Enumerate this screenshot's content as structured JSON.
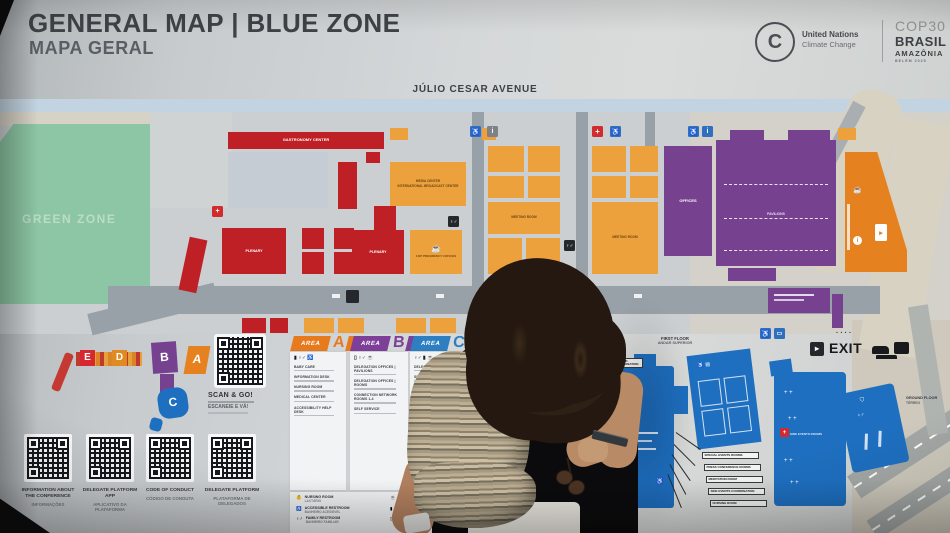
{
  "header": {
    "title": "GENERAL MAP | BLUE ZONE",
    "subtitle": "MAPA GERAL"
  },
  "logos": {
    "un_line1": "United Nations",
    "un_line2": "Climate Change",
    "cop": "COP30",
    "brasil": "BRASIL",
    "amazonia": "AMAZÔNIA",
    "belem": "BELÉM 2025"
  },
  "map": {
    "avenue": "JÚLIO CESAR AVENUE",
    "green_zone": "GREEN ZONE",
    "gastronomy_center": "GASTRONOMY CENTER",
    "plenary_left": "PLENARY",
    "plenary_right": "PLENARY",
    "media_center_line1": "MEDIA CENTER",
    "media_center_line2": "INTERNATIONAL BROADCAST CENTER",
    "cop_presidency": "COP PRESIDENCY OFFICES",
    "meeting_room": "MEETING ROOM",
    "offices": "OFFICES",
    "pavilions": "PAVILIONS",
    "side_events": "SIDE EVENTS ROOMS",
    "exit": "EXIT",
    "first_floor": "FIRST FLOOR",
    "first_floor_pt": "ANDAR SUPERIOR",
    "ground_floor": "GROUND FLOOR",
    "ground_floor_pt": "TÉRREO",
    "callout_side_events": "SIDE EVENTS AND EXHIBITS COORDINATION",
    "callouts": [
      "SPECIAL EVENTS ROOMS",
      "PRESS CONFERENCE ROOMS",
      "MEDITATION ROOM",
      "SIDE EVENTS COORDINATION",
      "NURSING ROOM"
    ]
  },
  "minimap": {
    "letters": [
      "E",
      "D",
      "B",
      "A",
      "C"
    ]
  },
  "scan": {
    "title": "SCAN & GO!",
    "subtitle": "ESCANEIE E VÁ!"
  },
  "areas": {
    "label": "AREA",
    "a": {
      "letter": "A",
      "items": [
        "BABY CARE",
        "INFORMATION DESK",
        "NURSING ROOM",
        "MEDICAL CENTER",
        "ACCESSIBILITY HELP DESK"
      ]
    },
    "b": {
      "letter": "B",
      "items": [
        "DELEGATION OFFICES | PAVILIONS",
        "DELEGATION OFFICES | ROOMS",
        "CONNECTION NETWORK ROOMS 1-4",
        "SELF SERVICE"
      ]
    },
    "c": {
      "letter": "C",
      "items": [
        "DELEGATION OFFICES",
        "SPECIAL EVENT ROOMS",
        "PRESS CONFERENCE ROOMS",
        "MEETING ROOMS"
      ]
    },
    "d": {
      "letter": "D"
    },
    "e": {
      "letter": "E",
      "items": [
        "PLENARY AMAZÔNIA",
        "PLENARY TOCANTINS",
        "HANGAR 13-16",
        "SPECIAL EVENTS ROOMS",
        "PRESS CONFERENCE CENTER",
        "EXIT TO THE GREEN ZONE"
      ]
    }
  },
  "facilities": [
    {
      "en": "NURSING ROOM",
      "pt": "LACTÁRIO"
    },
    {
      "en": "ACCESSIBLE RESTROOM",
      "pt": "BANHEIRO ACESSÍVEL"
    },
    {
      "en": "FAMILY RESTROOM",
      "pt": "BANHEIRO FAMILIAR"
    },
    {
      "en": "RESTAURANT",
      "pt": "RESTAURANTE"
    },
    {
      "en": "PRAYER ROOM",
      "pt": "SALA DE ORAÇÃO"
    },
    {
      "en": "SMOKING AREA",
      "pt": "ÁREA DE FUMANTES"
    }
  ],
  "qr_cards": [
    {
      "title": "INFORMATION ABOUT THE CONFERENCE",
      "subtitle": "INFORMAÇÕES"
    },
    {
      "title": "DELEGATE PLATFORM APP",
      "subtitle": "APLICATIVO DA PLATAFORMA"
    },
    {
      "title": "CODE OF CONDUCT",
      "subtitle": "CÓDIGO DE CONDUTA"
    },
    {
      "title": "DELEGATE PLATFORM",
      "subtitle": "PLATAFORMA DE DELEGADOS"
    }
  ],
  "colors": {
    "red": "#bf2026",
    "orange": "#eda13c",
    "purple": "#76418f",
    "blue": "#1e6fc0",
    "green": "#8cc6a4",
    "area_a": "#e87a1e",
    "area_b": "#7d3f98",
    "area_c": "#2e7fc2",
    "area_d": "#f0b02e",
    "area_e": "#d7282f"
  }
}
